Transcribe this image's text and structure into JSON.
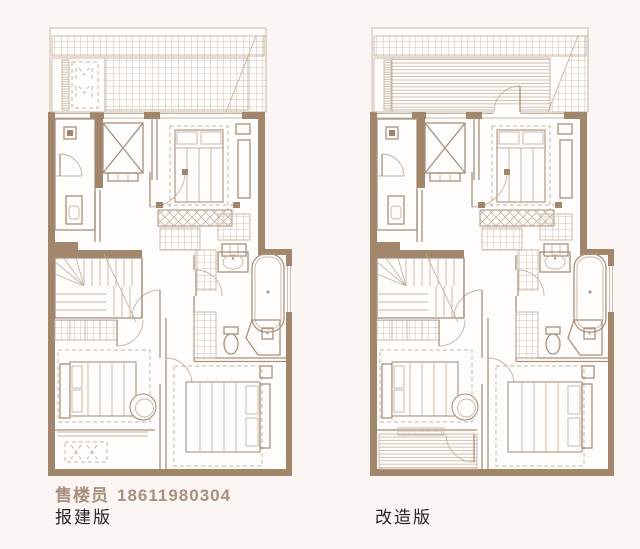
{
  "palette": {
    "line": "#a8907c",
    "line_light": "#c6b2a1",
    "wall": "#a1866c",
    "paper": "#fffdfc",
    "page_bg": "#fbf6f3",
    "text_dark": "#262626"
  },
  "contact": {
    "label": "售楼员",
    "phone": "18611980304"
  },
  "plans": [
    {
      "id": "approval",
      "name": "报建版"
    },
    {
      "id": "renovated",
      "name": "改造版"
    }
  ]
}
